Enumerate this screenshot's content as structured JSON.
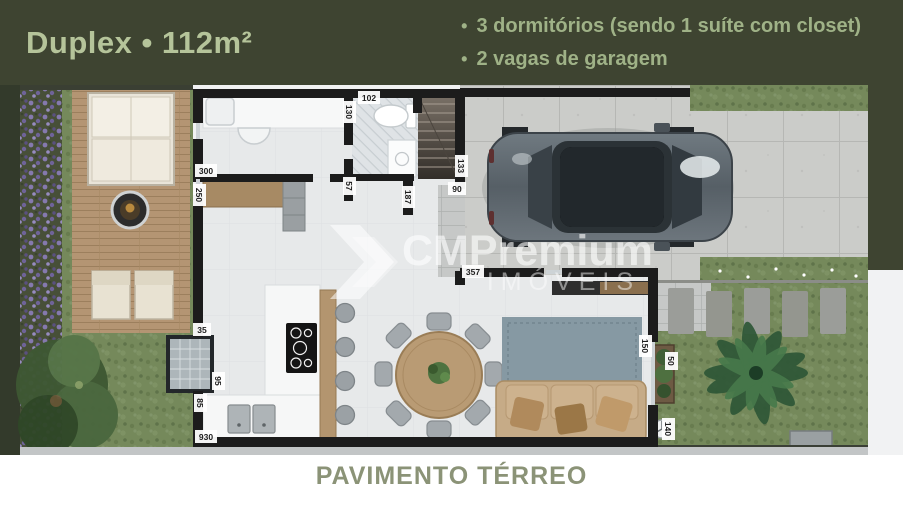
{
  "header": {
    "title": "Duplex • 112m²",
    "bullets": [
      {
        "marker": "•",
        "text": "3 dormitórios (sendo 1 suíte com closet)"
      },
      {
        "marker": "•",
        "text": "2 vagas de garagem"
      }
    ]
  },
  "watermark": {
    "brand": "CMPremium",
    "subtitle": "IMÓVEIS"
  },
  "footer": {
    "caption": "PAVIMENTO TÉRREO"
  },
  "plan": {
    "name": "Pavimento Térreo - planta baixa",
    "dimensions": {
      "d130": "130",
      "d102": "102",
      "d300": "300",
      "d250": "250",
      "d57": "57",
      "d187": "187",
      "d133": "133",
      "d90": "90",
      "d357": "357",
      "d35": "35",
      "d95": "95",
      "d85": "85",
      "d930": "930",
      "d150": "150",
      "d50": "50",
      "d140": "140"
    }
  },
  "colors": {
    "header_bg": "#3e4431",
    "title_text": "#b5c49a",
    "caption_text": "#8b9377",
    "wall": "#1c1c1c",
    "deck_wood": "#b49573",
    "grass": "#75895b",
    "driveway": "#cbccc9",
    "car_body": "#59626a"
  }
}
